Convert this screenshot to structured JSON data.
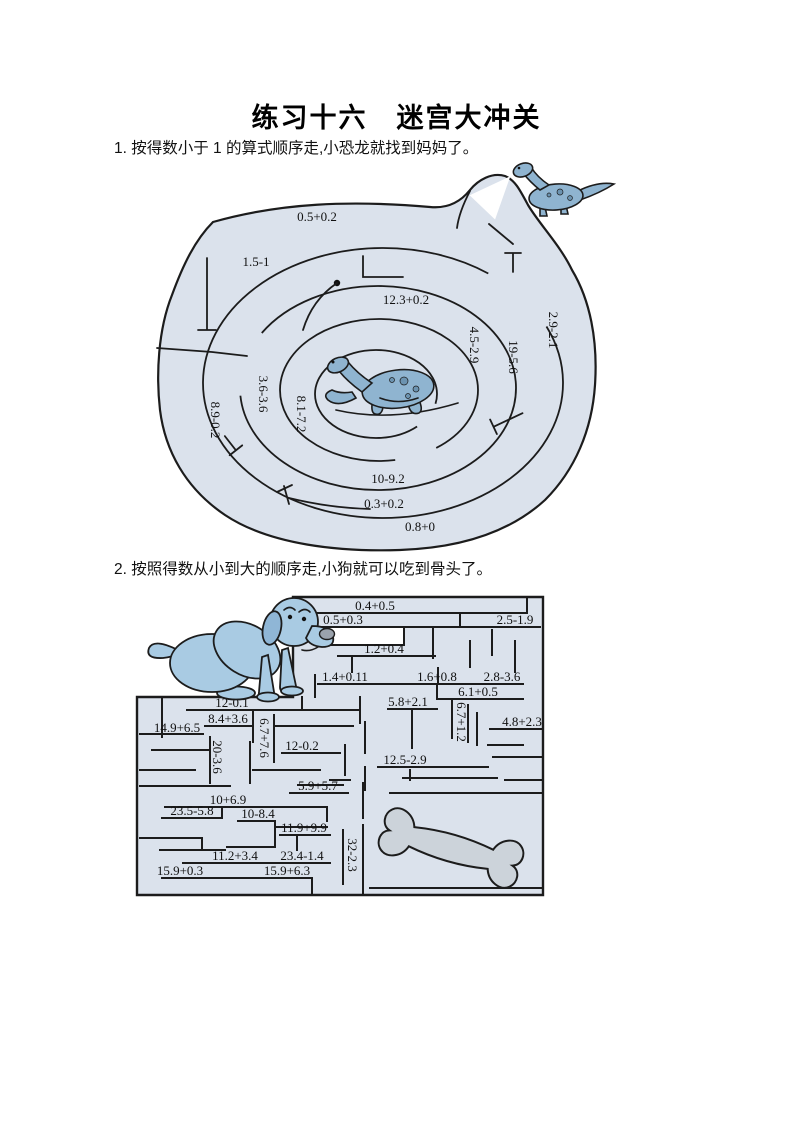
{
  "page": {
    "title": "练习十六　迷宫大冲关",
    "q1": "1. 按得数小于 1 的算式顺序走,小恐龙就找到妈妈了。",
    "q2": "2. 按照得数从小到大的顺序走,小狗就可以吃到骨头了。"
  },
  "colors": {
    "maze_fill": "#dbe2ec",
    "text": "#101010",
    "dino": "#8fb4d0",
    "dino_spot": "#6c93b0",
    "dog": "#a9cbe3",
    "dog_ear": "#8fb6d6",
    "bone": "#ccd3da",
    "nose": "#9aa2ac"
  },
  "figures": {
    "maze1_start": "baby-dinosaur",
    "maze1_goal": "mother-dinosaur",
    "maze2_start": "sad-dog",
    "maze2_goal": "bone"
  },
  "maze1": {
    "expressions": [
      "0.5+0.2",
      "1.5-1",
      "12.3+0.2",
      "4.5-2.9",
      "19-5.6",
      "2.9-2.1",
      "3.6-3.6",
      "8.9-0.2",
      "8.1-7.2",
      "10-9.2",
      "0.3+0.2",
      "0.8+0"
    ]
  },
  "maze2": {
    "expressions": [
      "0.4+0.5",
      "0.5+0.3",
      "2.5-1.9",
      "1.2+0.4",
      "1.4+0.11",
      "1.6+0.8",
      "2.8-3.6",
      "6.1+0.5",
      "12-0.1",
      "5.8+2.1",
      "8.4+3.6",
      "14.9+6.5",
      "6.7+7.6",
      "20-3.6",
      "12-0.2",
      "12.5-2.9",
      "6.7+1.2",
      "4.8+2.3",
      "5.9+5.7",
      "10+6.9",
      "23.5-5.8",
      "10-8.4",
      "11.9+9.9",
      "32-2.3",
      "11.2+3.4",
      "23.4-1.4",
      "15.9+0.3",
      "15.9+6.3"
    ]
  }
}
